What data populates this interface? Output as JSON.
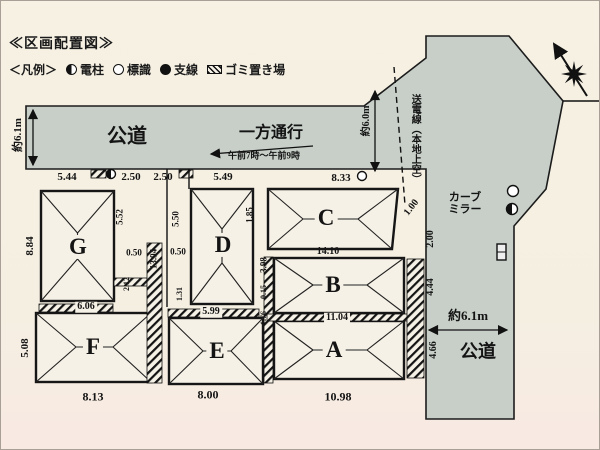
{
  "title": "≪区画配置図≫",
  "legend": {
    "label": "＜凡例＞",
    "items": [
      {
        "icon": "utility-pole",
        "shape": "half-circle",
        "label": "電柱"
      },
      {
        "icon": "road-sign",
        "shape": "circle",
        "label": "標識"
      },
      {
        "icon": "guy-wire",
        "shape": "dot",
        "label": "支線"
      },
      {
        "icon": "garbage-area",
        "shape": "hatch",
        "label": "ゴミ置き場"
      }
    ]
  },
  "colors": {
    "road": "#c7cfc8",
    "paper": "#f5efe2",
    "lot": "#f6f1e6",
    "ink": "#1a1a1a"
  },
  "roads": {
    "top_label": "公道",
    "right_label": "公道",
    "top_width": "約6.1m",
    "right_width": "約6.1m",
    "junction_width": "約6.0m"
  },
  "notes": {
    "one_way": "一方通行",
    "one_way_time": "午前7時～午前9時",
    "power_line": "送電線（本地上空）",
    "curve_mirror": "カーブ\nミラー"
  },
  "lots": [
    "A",
    "B",
    "C",
    "D",
    "E",
    "F",
    "G"
  ],
  "annotations": [
    {
      "name": "dim-top-1",
      "text": "5.44",
      "x": 66,
      "y": 177,
      "size": 11
    },
    {
      "name": "dim-top-2",
      "text": "2.50",
      "x": 130,
      "y": 177,
      "size": 11
    },
    {
      "name": "dim-top-3",
      "text": "2.50",
      "x": 162,
      "y": 177,
      "size": 11
    },
    {
      "name": "dim-top-4",
      "text": "5.49",
      "x": 222,
      "y": 177,
      "size": 11
    },
    {
      "name": "dim-top-5",
      "text": "8.33",
      "x": 340,
      "y": 178,
      "size": 11
    },
    {
      "name": "dim-c-bottom",
      "text": "14.10",
      "x": 327,
      "y": 251,
      "size": 10
    },
    {
      "name": "dim-b-bottom",
      "text": "11.04",
      "x": 336,
      "y": 317,
      "size": 10,
      "cls": "bandbg"
    },
    {
      "name": "dim-a-bottom",
      "text": "10.98",
      "x": 337,
      "y": 396,
      "size": 12
    },
    {
      "name": "dim-e-bottom",
      "text": "8.00",
      "x": 207,
      "y": 394,
      "size": 12
    },
    {
      "name": "dim-f-bottom",
      "text": "8.13",
      "x": 92,
      "y": 396,
      "size": 12
    },
    {
      "name": "dim-g-bottom",
      "text": "6.06",
      "x": 85,
      "y": 306,
      "size": 10,
      "cls": "bandbg"
    },
    {
      "name": "dim-e-top",
      "text": "5.99",
      "x": 210,
      "y": 311,
      "size": 10,
      "cls": "bandbg"
    },
    {
      "name": "dim-g-left",
      "text": "8.84",
      "x": 30,
      "y": 245,
      "rot": -90,
      "size": 11
    },
    {
      "name": "dim-f-left",
      "text": "5.08",
      "x": 25,
      "y": 347,
      "rot": -90,
      "size": 11
    },
    {
      "name": "dim-g-right",
      "text": "5.52",
      "x": 119,
      "y": 216,
      "rot": -90,
      "size": 9
    },
    {
      "name": "dim-strip-length",
      "text": "13.94",
      "x": 153,
      "y": 258,
      "rot": -90,
      "size": 9
    },
    {
      "name": "dim-gap-left",
      "text": "0.50",
      "x": 133,
      "y": 252,
      "size": 9
    },
    {
      "name": "dim-gap-right",
      "text": "0.50",
      "x": 177,
      "y": 251,
      "size": 9
    },
    {
      "name": "dim-pole",
      "text": "5.50",
      "x": 175,
      "y": 218,
      "rot": -90,
      "size": 9
    },
    {
      "name": "dim-small-1",
      "text": "2.12",
      "x": 126,
      "y": 283,
      "rot": -90,
      "size": 8
    },
    {
      "name": "dim-small-2",
      "text": "1.31",
      "x": 179,
      "y": 293,
      "rot": -90,
      "size": 8
    },
    {
      "name": "dim-c-left",
      "text": "1.85",
      "x": 249,
      "y": 214,
      "rot": -90,
      "size": 9
    },
    {
      "name": "dim-b-left",
      "text": "3.98",
      "x": 263,
      "y": 264,
      "rot": -90,
      "size": 9
    },
    {
      "name": "dim-small-3",
      "text": "0.15",
      "x": 263,
      "y": 291,
      "rot": -90,
      "size": 8
    },
    {
      "name": "dim-small-4",
      "text": "1.76",
      "x": 263,
      "y": 317,
      "rot": -90,
      "size": 8
    },
    {
      "name": "dim-road-1",
      "text": "1.00",
      "x": 411,
      "y": 207,
      "rot": -52,
      "size": 10
    },
    {
      "name": "dim-road-2",
      "text": "2.00",
      "x": 430,
      "y": 238,
      "rot": -90,
      "size": 10
    },
    {
      "name": "dim-road-3",
      "text": "4.44",
      "x": 430,
      "y": 286,
      "rot": -90,
      "size": 10
    },
    {
      "name": "dim-road-4",
      "text": "4.66",
      "x": 433,
      "y": 349,
      "rot": -90,
      "size": 10
    },
    {
      "name": "road-width-left",
      "text": "約6.1m",
      "x": 18,
      "y": 134,
      "rot": -90,
      "size": 11
    },
    {
      "name": "road-width-junction",
      "text": "約6.0m",
      "x": 366,
      "y": 120,
      "rot": -90,
      "size": 10
    },
    {
      "name": "road-width-right",
      "text": "約6.1m",
      "x": 467,
      "y": 315,
      "size": 13
    },
    {
      "name": "road-label-top",
      "text": "公道",
      "x": 126,
      "y": 136,
      "size": 20
    },
    {
      "name": "road-label-right",
      "text": "公道",
      "x": 477,
      "y": 351,
      "size": 18
    },
    {
      "name": "one-way-label",
      "text": "一方通行",
      "x": 270,
      "y": 133,
      "size": 16
    },
    {
      "name": "one-way-time",
      "text": "午前7時～午前9時",
      "x": 263,
      "y": 155,
      "size": 9
    },
    {
      "name": "power-line-label",
      "text": "送電線（本地上空）",
      "x": 413,
      "y": 138,
      "vertical": true,
      "size": 10
    },
    {
      "name": "curve-mirror-label",
      "text": "カーブ\nミラー",
      "x": 464,
      "y": 203,
      "size": 11
    },
    {
      "name": "lot-label-g",
      "text": "G",
      "x": 77,
      "y": 246,
      "size": 23,
      "cls": "lotbg"
    },
    {
      "name": "lot-label-f",
      "text": "F",
      "x": 92,
      "y": 346,
      "size": 23,
      "cls": "lotbg"
    },
    {
      "name": "lot-label-d",
      "text": "D",
      "x": 222,
      "y": 244,
      "size": 23,
      "cls": "lotbg"
    },
    {
      "name": "lot-label-e",
      "text": "E",
      "x": 216,
      "y": 350,
      "size": 23,
      "cls": "lotbg"
    },
    {
      "name": "lot-label-c",
      "text": "C",
      "x": 325,
      "y": 217,
      "size": 23,
      "cls": "lotbg"
    },
    {
      "name": "lot-label-b",
      "text": "B",
      "x": 332,
      "y": 284,
      "size": 23,
      "cls": "lotbg"
    },
    {
      "name": "lot-label-a",
      "text": "A",
      "x": 333,
      "y": 349,
      "size": 23,
      "cls": "lotbg"
    }
  ]
}
